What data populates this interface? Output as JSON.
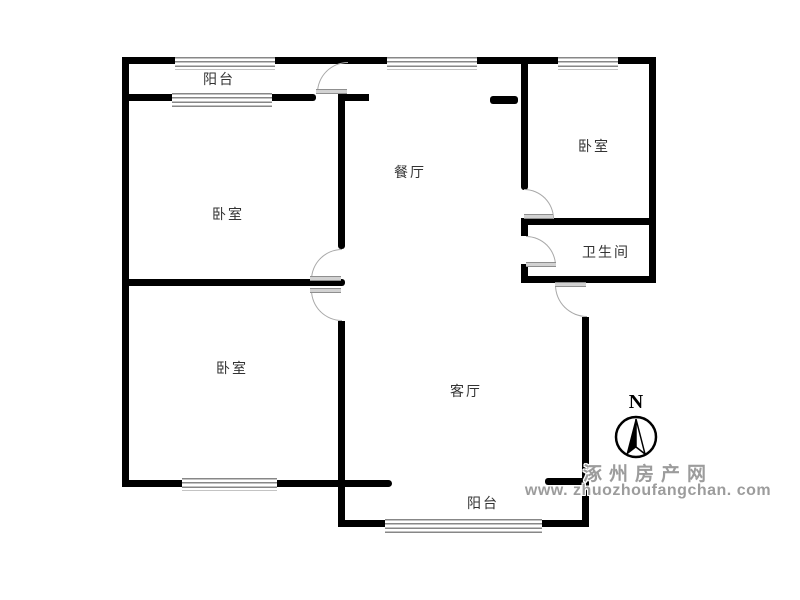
{
  "plan": {
    "type": "apartment-floor-plan",
    "rooms": {
      "balcony_top": {
        "label": "阳台"
      },
      "bedroom_upper_left": {
        "label": "卧室"
      },
      "bedroom_lower_left": {
        "label": "卧室"
      },
      "dining": {
        "label": "餐厅"
      },
      "living": {
        "label": "客厅"
      },
      "bedroom_right": {
        "label": "卧室"
      },
      "bathroom": {
        "label": "卫生间"
      },
      "balcony_bottom": {
        "label": "阳台"
      }
    },
    "north": {
      "label": "N"
    }
  },
  "watermark": {
    "line1": "涿州房产网",
    "line2": "www. zhuozhoufangchan. com"
  },
  "colors": {
    "wall": "#000000",
    "door_arc": "#a9a9a9",
    "window_hatch": "#878787",
    "label_text": "#333333",
    "watermark_text": "#9c9c9c",
    "background": "#ffffff"
  }
}
